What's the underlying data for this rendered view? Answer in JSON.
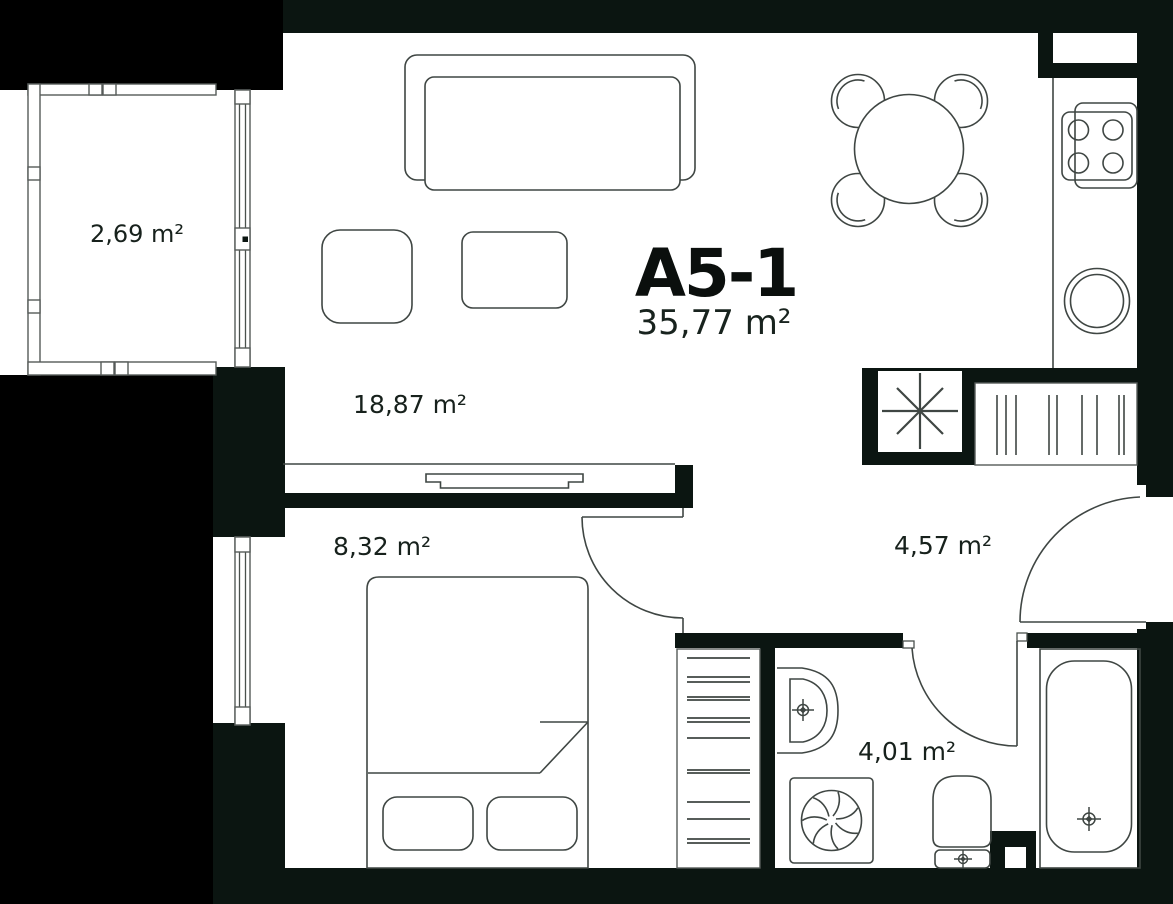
{
  "plan": {
    "unit": {
      "id": "A5-1",
      "total_area": "35,77 m²"
    },
    "rooms": [
      {
        "key": "balcony",
        "area": "2,69 m²"
      },
      {
        "key": "living-kitchen",
        "area": "18,87 m²"
      },
      {
        "key": "bedroom",
        "area": "8,32 m²"
      },
      {
        "key": "hallway",
        "area": "4,57 m²"
      },
      {
        "key": "bathroom",
        "area": "4,01 m²"
      }
    ],
    "fixtures": [
      "sofa",
      "coffee-table",
      "pouf",
      "tv-console",
      "dining-table",
      "dining-chair",
      "kitchen-counter",
      "stove",
      "kitchen-sink",
      "ventilation-shaft",
      "wardrobe",
      "balcony-window",
      "bedroom-window",
      "bed",
      "pillow",
      "closet-shelves",
      "washbasin",
      "washing-machine",
      "toilet",
      "bathtub",
      "door-swing"
    ],
    "colors": {
      "wall": "#0b1511",
      "outside": "#000000",
      "line": "#3f4643",
      "text": "#17211c"
    }
  }
}
